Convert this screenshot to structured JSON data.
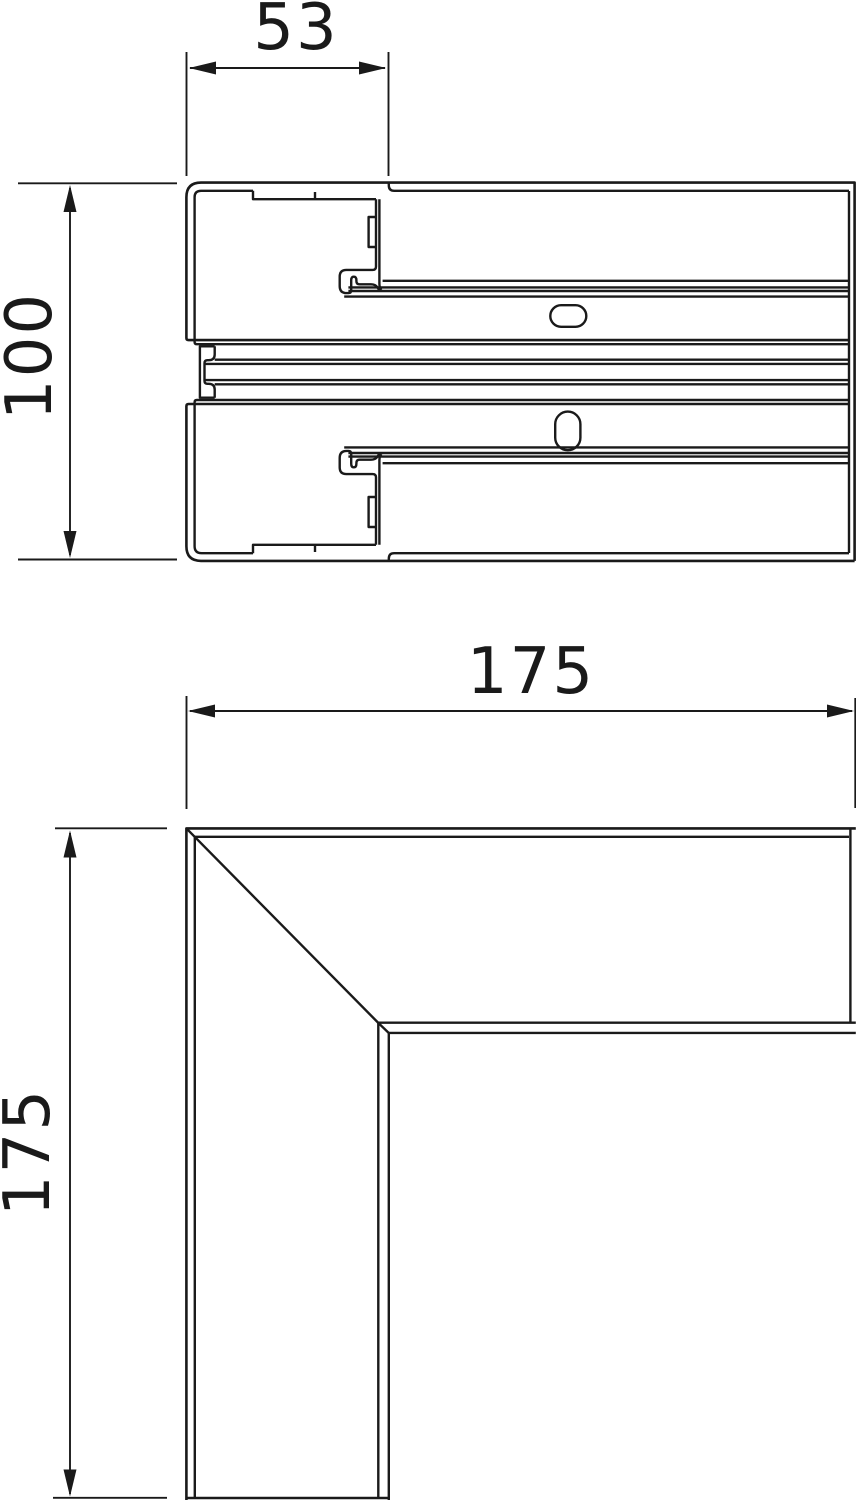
{
  "drawing": {
    "description": "Technical dimension drawing of a cable trunking: cross-section profile and flat corner piece",
    "line_color": "#1a1a1a",
    "background_color": "#ffffff",
    "profile_view": {
      "name": "trunking cross-section profile",
      "width_label": "53",
      "height_label": "100"
    },
    "corner_view": {
      "name": "flat angle corner piece",
      "width_label": "175",
      "height_label": "175"
    }
  }
}
